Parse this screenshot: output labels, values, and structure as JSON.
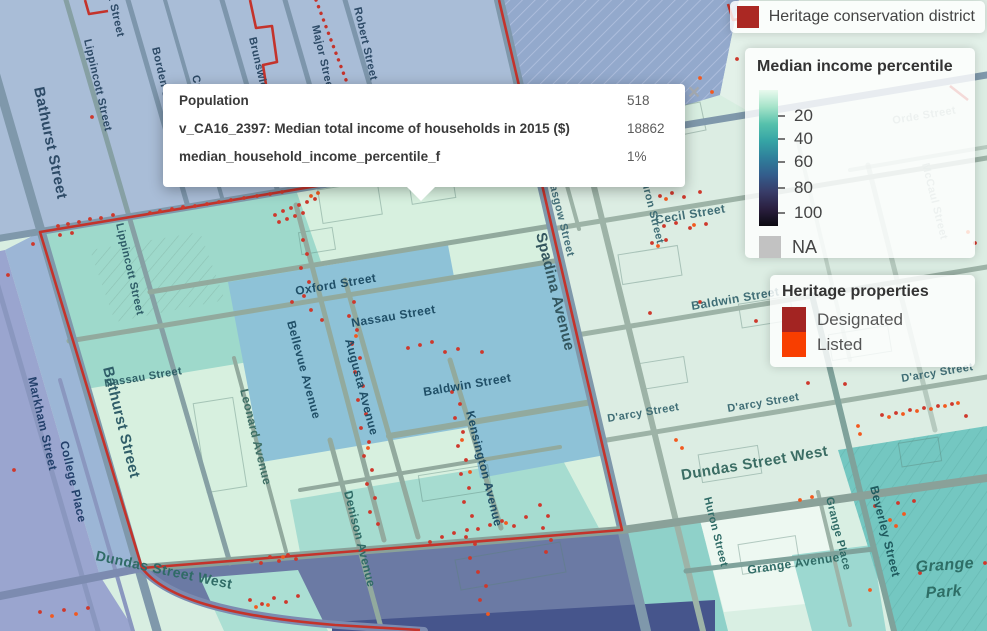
{
  "popup": {
    "close": "×",
    "rows": [
      {
        "label": "Population",
        "value": "518"
      },
      {
        "label": "v_CA16_2397: Median total income of households in 2015 ($)",
        "value": "18862"
      },
      {
        "label": "median_household_income_percentile_f",
        "value": "1%"
      }
    ]
  },
  "legends": {
    "district": {
      "title": "Heritage conservation district",
      "color": "#ab2823"
    },
    "income": {
      "title": "Median income percentile",
      "ticks": [
        "20",
        "40",
        "60",
        "80",
        "100"
      ],
      "gradient": [
        "#e9faee",
        "#a5e3c9",
        "#56c1ac",
        "#35a4a5",
        "#2f7f9b",
        "#335d8c",
        "#383c68",
        "#2a1f3f",
        "#0b0a11"
      ],
      "na_label": "NA",
      "na_color": "#c2c2c2"
    },
    "heritage": {
      "title": "Heritage properties",
      "items": [
        {
          "label": "Designated",
          "color": "#a32422"
        },
        {
          "label": "Listed",
          "color": "#f83e00"
        }
      ]
    }
  },
  "map": {
    "labels": {
      "bathurst": "Bathurst Street",
      "lippincott": "Lippincott Street",
      "borden": "Borden Street",
      "croft": "Croft Street",
      "brunswick": "Brunswick Av",
      "major": "Major Street",
      "robert": "Robert Street",
      "college": "College",
      "oxford": "Oxford Street",
      "nassau": "Nassau Street",
      "bellevue": "Bellevue Avenue",
      "augusta": "Augusta Avenue",
      "baldwin": "Baldwin Street",
      "kensington": "Kensington Avenue",
      "spadina": "Spadina Avenue",
      "glasgow": "Glasgow Street",
      "huron": "Huron Street",
      "cecil": "Cecil Street",
      "darcy": "D'arcy Street",
      "dundas": "Dundas Street West",
      "leonard": "Leonard Avenue",
      "denison": "Denison Avenue",
      "markham": "Markham Street",
      "college_place": "College Place",
      "grange_ave": "Grange Avenue",
      "grange_place": "Grange Place",
      "beverley": "Beverley Street",
      "grange": "Grange",
      "park": "Park",
      "orde": "Orde Street",
      "mccaul": "McCaul Street"
    },
    "point_colors": {
      "designated": "#ce382c",
      "listed": "#f2591f"
    },
    "points": {
      "designated": [
        [
          58,
          226
        ],
        [
          68,
          224
        ],
        [
          79,
          222
        ],
        [
          90,
          219
        ],
        [
          101,
          218
        ],
        [
          113,
          215
        ],
        [
          150,
          213
        ],
        [
          160,
          211
        ],
        [
          172,
          209
        ],
        [
          183,
          207
        ],
        [
          195,
          206
        ],
        [
          207,
          204
        ],
        [
          219,
          202
        ],
        [
          231,
          200
        ],
        [
          244,
          198
        ],
        [
          257,
          196
        ],
        [
          270,
          194
        ],
        [
          282,
          192
        ],
        [
          60,
          235
        ],
        [
          72,
          233
        ],
        [
          275,
          215
        ],
        [
          283,
          211
        ],
        [
          291,
          208
        ],
        [
          299,
          205
        ],
        [
          307,
          202
        ],
        [
          315,
          199
        ],
        [
          279,
          222
        ],
        [
          287,
          219
        ],
        [
          295,
          216
        ],
        [
          303,
          213
        ],
        [
          303,
          240
        ],
        [
          307,
          254
        ],
        [
          301,
          268
        ],
        [
          309,
          282
        ],
        [
          304,
          296
        ],
        [
          311,
          310
        ],
        [
          322,
          320
        ],
        [
          292,
          302
        ],
        [
          354,
          302
        ],
        [
          349,
          316
        ],
        [
          357,
          330
        ],
        [
          352,
          344
        ],
        [
          360,
          358
        ],
        [
          355,
          372
        ],
        [
          363,
          386
        ],
        [
          358,
          400
        ],
        [
          366,
          414
        ],
        [
          361,
          428
        ],
        [
          369,
          442
        ],
        [
          364,
          456
        ],
        [
          372,
          470
        ],
        [
          367,
          484
        ],
        [
          375,
          498
        ],
        [
          370,
          512
        ],
        [
          378,
          524
        ],
        [
          408,
          348
        ],
        [
          420,
          345
        ],
        [
          432,
          342
        ],
        [
          445,
          352
        ],
        [
          458,
          349
        ],
        [
          482,
          352
        ],
        [
          452,
          392
        ],
        [
          460,
          404
        ],
        [
          455,
          418
        ],
        [
          463,
          432
        ],
        [
          458,
          446
        ],
        [
          466,
          460
        ],
        [
          461,
          474
        ],
        [
          469,
          488
        ],
        [
          464,
          502
        ],
        [
          472,
          516
        ],
        [
          467,
          530
        ],
        [
          475,
          544
        ],
        [
          470,
          558
        ],
        [
          478,
          572
        ],
        [
          486,
          586
        ],
        [
          480,
          600
        ],
        [
          540,
          505
        ],
        [
          548,
          516
        ],
        [
          543,
          528
        ],
        [
          551,
          540
        ],
        [
          546,
          552
        ],
        [
          252,
          560
        ],
        [
          261,
          563
        ],
        [
          270,
          557
        ],
        [
          279,
          561
        ],
        [
          288,
          555
        ],
        [
          296,
          559
        ],
        [
          250,
          600
        ],
        [
          262,
          604
        ],
        [
          274,
          598
        ],
        [
          286,
          602
        ],
        [
          298,
          596
        ],
        [
          430,
          542
        ],
        [
          442,
          537
        ],
        [
          454,
          533
        ],
        [
          466,
          537
        ],
        [
          478,
          529
        ],
        [
          490,
          525
        ],
        [
          502,
          521
        ],
        [
          514,
          526
        ],
        [
          526,
          517
        ],
        [
          660,
          196
        ],
        [
          672,
          193
        ],
        [
          684,
          197
        ],
        [
          700,
          192
        ],
        [
          664,
          226
        ],
        [
          676,
          223
        ],
        [
          690,
          228
        ],
        [
          706,
          224
        ],
        [
          652,
          243
        ],
        [
          666,
          240
        ],
        [
          650,
          313
        ],
        [
          700,
          302
        ],
        [
          756,
          321
        ],
        [
          808,
          383
        ],
        [
          845,
          384
        ],
        [
          882,
          415
        ],
        [
          896,
          413
        ],
        [
          910,
          410
        ],
        [
          924,
          408
        ],
        [
          938,
          406
        ],
        [
          952,
          404
        ],
        [
          875,
          506
        ],
        [
          898,
          503
        ],
        [
          914,
          501
        ],
        [
          985,
          563
        ],
        [
          737,
          59
        ],
        [
          975,
          243
        ],
        [
          920,
          573
        ],
        [
          8,
          275
        ],
        [
          33,
          244
        ],
        [
          14,
          470
        ],
        [
          966,
          416
        ],
        [
          92,
          117
        ],
        [
          40,
          612
        ],
        [
          64,
          610
        ],
        [
          88,
          608
        ]
      ],
      "listed": [
        [
          218,
          137
        ],
        [
          311,
          196
        ],
        [
          318,
          193
        ],
        [
          356,
          336
        ],
        [
          368,
          448
        ],
        [
          462,
          440
        ],
        [
          470,
          472
        ],
        [
          488,
          614
        ],
        [
          666,
          199
        ],
        [
          694,
          225
        ],
        [
          658,
          246
        ],
        [
          628,
          168
        ],
        [
          642,
          166
        ],
        [
          889,
          417
        ],
        [
          903,
          414
        ],
        [
          917,
          411
        ],
        [
          931,
          409
        ],
        [
          945,
          406
        ],
        [
          958,
          403
        ],
        [
          858,
          426
        ],
        [
          860,
          434
        ],
        [
          676,
          440
        ],
        [
          682,
          448
        ],
        [
          890,
          520
        ],
        [
          896,
          526
        ],
        [
          904,
          514
        ],
        [
          870,
          590
        ],
        [
          283,
          557
        ],
        [
          506,
          523
        ],
        [
          256,
          607
        ],
        [
          268,
          605
        ],
        [
          712,
          92
        ],
        [
          700,
          78
        ],
        [
          968,
          232
        ],
        [
          800,
          500
        ],
        [
          812,
          497
        ],
        [
          52,
          616
        ],
        [
          76,
          614
        ]
      ]
    }
  }
}
